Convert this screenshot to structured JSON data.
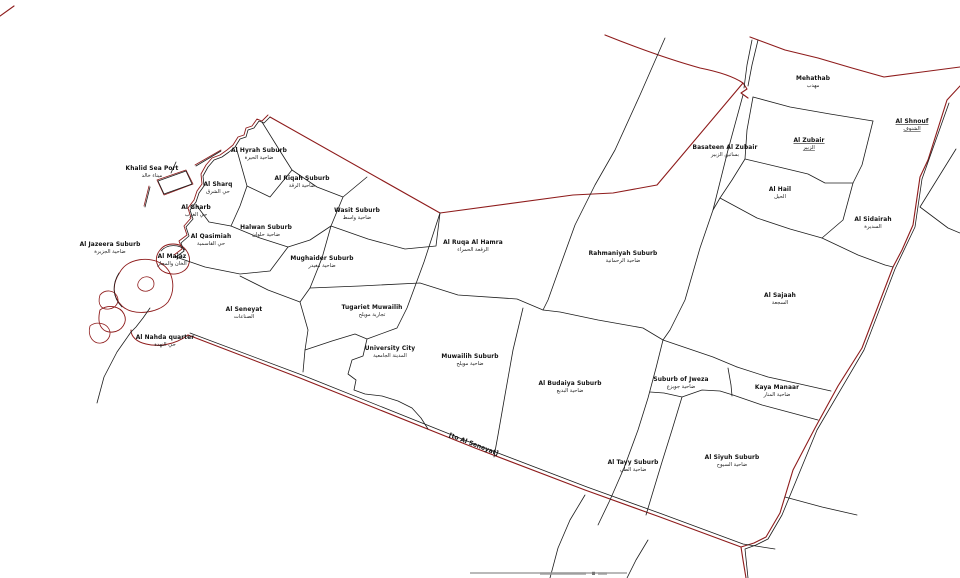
{
  "map": {
    "name": "Sharjah city districts map",
    "colors": {
      "background": "#ffffff",
      "district_line": "#1c1c1c",
      "boundary_red": "#8e1b1b",
      "label_text": "#111111"
    },
    "districts": [
      {
        "en": "Khalid Sea Port",
        "ar": "ميناء خالد",
        "x": 152,
        "y": 170,
        "underline": false
      },
      {
        "en": "Al Hyrah Suburb",
        "ar": "ضاحية الحيرة",
        "x": 259,
        "y": 152,
        "underline": false
      },
      {
        "en": "Al Sharq",
        "ar": "حي الشرق",
        "x": 218,
        "y": 186,
        "underline": false
      },
      {
        "en": "Al Riqah Suburb",
        "ar": "ضاحية الرقة",
        "x": 302,
        "y": 180,
        "underline": false
      },
      {
        "en": "Al Gharb",
        "ar": "حي الغرب",
        "x": 196,
        "y": 209,
        "underline": false
      },
      {
        "en": "Halwan Suburb",
        "ar": "ضاحية حلوان",
        "x": 266,
        "y": 229,
        "underline": false
      },
      {
        "en": "Wasit Suburb",
        "ar": "ضاحية واسط",
        "x": 357,
        "y": 212,
        "underline": false
      },
      {
        "en": "Al Qasimiah",
        "ar": "حي القاسمية",
        "x": 211,
        "y": 238,
        "underline": false
      },
      {
        "en": "Al Jazeera Suburb",
        "ar": "ضاحية الجزيرة",
        "x": 110,
        "y": 246,
        "underline": false
      },
      {
        "en": "Al Majaz",
        "ar": "الخان والمجاز",
        "x": 172,
        "y": 258,
        "underline": false
      },
      {
        "en": "Mughaider Suburb",
        "ar": "ضاحية مغيدر",
        "x": 322,
        "y": 260,
        "underline": false
      },
      {
        "en": "Al Ruqa Al Hamra",
        "ar": "الرقعة الحمراء",
        "x": 473,
        "y": 244,
        "underline": false
      },
      {
        "en": "Rahmaniyah Suburb",
        "ar": "ضاحية الرحمانية",
        "x": 623,
        "y": 255,
        "underline": false
      },
      {
        "en": "Al Sajaah",
        "ar": "السجعة",
        "x": 780,
        "y": 297,
        "underline": false
      },
      {
        "en": "Al Seneyat",
        "ar": "الصناعات",
        "x": 244,
        "y": 311,
        "underline": false
      },
      {
        "en": "Al Nahda quarter",
        "ar": "حي النهدة",
        "x": 165,
        "y": 339,
        "underline": false
      },
      {
        "en": "Tugariet Muwailih",
        "ar": "تجارية مويلح",
        "x": 372,
        "y": 309,
        "underline": false
      },
      {
        "en": "University City",
        "ar": "المدينة الجامعية",
        "x": 390,
        "y": 350,
        "underline": false
      },
      {
        "en": "Muwailih Suburb",
        "ar": "ضاحية مويلح",
        "x": 470,
        "y": 358,
        "underline": false
      },
      {
        "en": "Al Budaiya Suburb",
        "ar": "ضاحية البديع",
        "x": 570,
        "y": 385,
        "underline": false
      },
      {
        "en": "Suburb of Jweza",
        "ar": "ضاحية جويزع",
        "x": 681,
        "y": 381,
        "underline": false
      },
      {
        "en": "Kaya Manaar",
        "ar": "ضاحية المنار",
        "x": 777,
        "y": 389,
        "underline": false
      },
      {
        "en": "Al Tayy Suburb",
        "ar": "ضاحية الطي",
        "x": 633,
        "y": 464,
        "underline": false
      },
      {
        "en": "Al Siyuh Suburb",
        "ar": "ضاحية السيوح",
        "x": 732,
        "y": 459,
        "underline": false
      },
      {
        "en": "Mehathab",
        "ar": "مهذب",
        "x": 813,
        "y": 80,
        "underline": false
      },
      {
        "en": "Basateen Al Zubair",
        "ar": "بساتين الزبير",
        "x": 725,
        "y": 149,
        "underline": false
      },
      {
        "en": "Al Zubair",
        "ar": "الزبير",
        "x": 809,
        "y": 142,
        "underline": true
      },
      {
        "en": "Al Shnouf",
        "ar": "الشنوف",
        "x": 912,
        "y": 123,
        "underline": true
      },
      {
        "en": "Al Hail",
        "ar": "الحيل",
        "x": 780,
        "y": 191,
        "underline": false
      },
      {
        "en": "Al Sidairah",
        "ar": "السديرة",
        "x": 873,
        "y": 221,
        "underline": false
      }
    ],
    "annotations": [
      {
        "text": "[to Al Seneyat]",
        "x": 473,
        "y": 446,
        "rotation": 21
      }
    ]
  }
}
